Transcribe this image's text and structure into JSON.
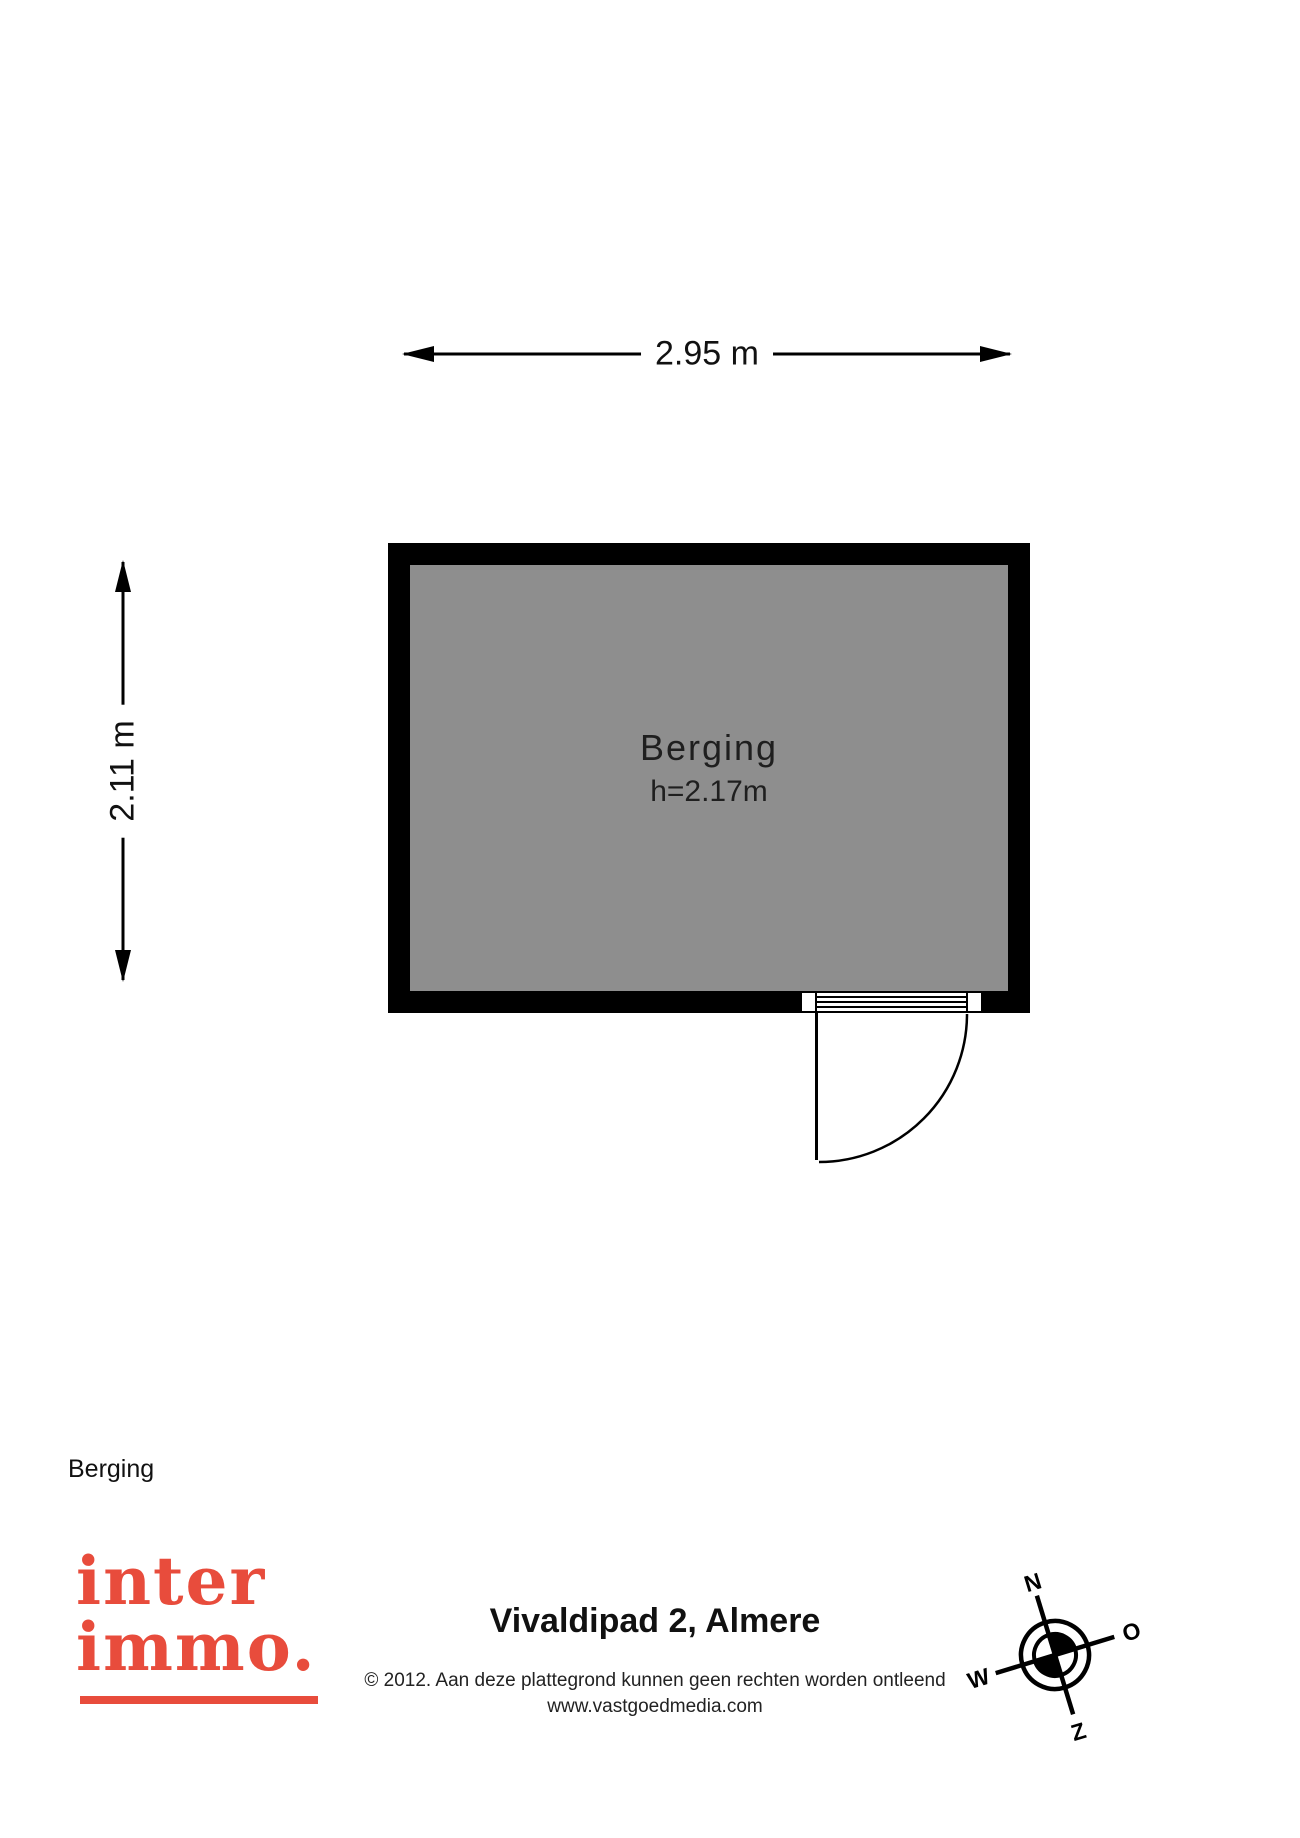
{
  "colors": {
    "room_fill": "#8E8E8E",
    "wall": "#000000",
    "logo_red": "#E84C3C",
    "text": "#1A1A1A"
  },
  "plan": {
    "width_dimension": "2.95 m",
    "height_dimension": "2.11 m",
    "room_name": "Berging",
    "room_ceiling_height": "h=2.17m"
  },
  "footer": {
    "floor_label": "Berging",
    "logo_line1": "inter",
    "logo_line2": "immo.",
    "address": "Vivaldipad 2, Almere",
    "copyright": "© 2012. Aan deze plattegrond kunnen geen rechten worden ontleend",
    "website": "www.vastgoedmedia.com"
  },
  "compass": {
    "north": "N",
    "east": "O",
    "south": "Z",
    "west": "W"
  }
}
